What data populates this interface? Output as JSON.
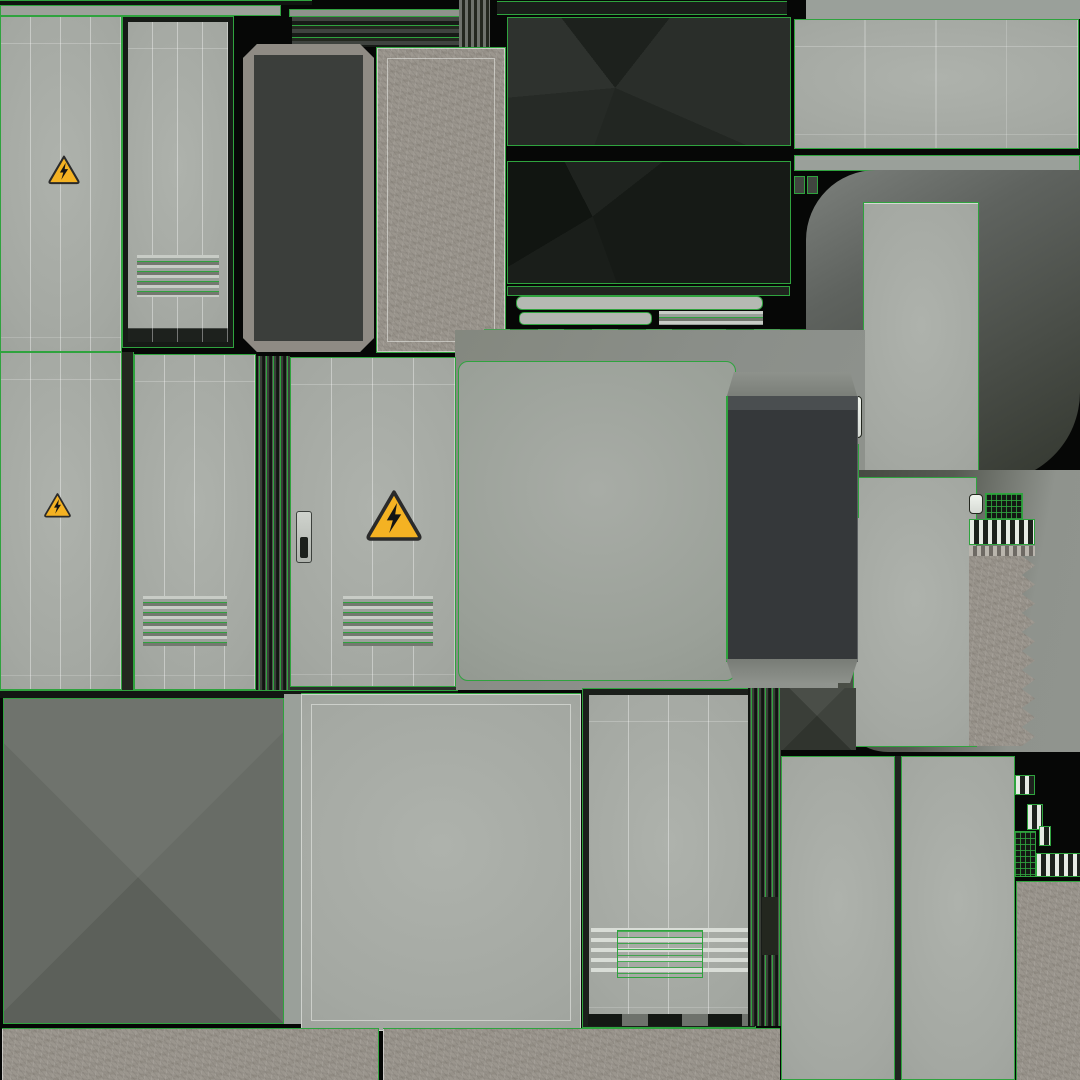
{
  "meta": {
    "title": "Electrical cabinet texture atlas",
    "canvas": {
      "w": 1080,
      "h": 1080
    },
    "background": "#060706"
  },
  "palette": {
    "uv_wireframe_green": "#2fa33e",
    "panel_gray_light": "#aeb2ac",
    "panel_gray": "#a4a8a2",
    "field_gray": "#8b8f8a",
    "charcoal": "#35383a",
    "near_black": "#171b17",
    "concrete": "#9b968e",
    "warning_yellow": "#f4b223",
    "danger_red": "#b3242c",
    "white_line": "#e8ece6"
  },
  "signs": {
    "danger_label": {
      "danger_text": "DANGER",
      "warn_glyph": "⚠",
      "line1": "HIGH",
      "line2": "VOLTAGE",
      "rect": {
        "x": 175,
        "y": 499,
        "w": 60,
        "h": 44
      }
    },
    "warning_triangles": [
      {
        "name": "high-voltage-warning-icon",
        "x": 47,
        "y": 153,
        "w": 34,
        "h": 33
      },
      {
        "name": "high-voltage-warning-icon",
        "x": 43,
        "y": 491,
        "w": 29,
        "h": 28
      },
      {
        "name": "high-voltage-warning-icon",
        "x": 364,
        "y": 487,
        "w": 60,
        "h": 56
      }
    ]
  },
  "panels": [
    {
      "name": "separator-top-dark",
      "kind": "bar",
      "x": 0,
      "y": 0,
      "w": 312,
      "h": 5,
      "css": {
        "background": "#101410",
        "boxShadow": "inset 0 1px 0 #2fa33e"
      }
    },
    {
      "name": "rail-top-left",
      "kind": "bar gb",
      "x": 0,
      "y": 5,
      "w": 281,
      "h": 11,
      "css": {
        "background": "#9da19b"
      }
    },
    {
      "name": "rail-top-mid",
      "kind": "bar gb",
      "x": 289,
      "y": 9,
      "w": 173,
      "h": 8,
      "css": {
        "background": "#8f938d"
      }
    },
    {
      "name": "vent-top-horizontal",
      "kind": "vent-h-dark",
      "x": 292,
      "y": 17,
      "w": 172,
      "h": 30
    },
    {
      "name": "vent-top-vertical",
      "kind": "vent-v-dark",
      "x": 459,
      "y": 0,
      "w": 31,
      "h": 48
    },
    {
      "name": "rail-top-dark",
      "kind": "bar",
      "x": 497,
      "y": 1,
      "w": 290,
      "h": 14,
      "css": {
        "background": "#1a1e1a",
        "boxShadow": "inset 0 1px 0 #2fa33e, inset 0 -1px 0 #2fa33e"
      }
    },
    {
      "name": "field-top-right",
      "kind": "bar",
      "x": 806,
      "y": 0,
      "w": 274,
      "h": 19,
      "css": {
        "background": "#9aa09a"
      }
    },
    {
      "name": "panel-top-right",
      "kind": "plate gb seams",
      "x": 794,
      "y": 19,
      "w": 285,
      "h": 130
    },
    {
      "name": "rail-top-right",
      "kind": "bar gb",
      "x": 794,
      "y": 155,
      "w": 286,
      "h": 16,
      "css": {
        "background": "#9aa09a"
      }
    },
    {
      "name": "hinge-block-1",
      "kind": "bar gb",
      "x": 794,
      "y": 176,
      "w": 11,
      "h": 18,
      "css": {
        "background": "#40453f"
      }
    },
    {
      "name": "hinge-block-2",
      "kind": "bar gb",
      "x": 807,
      "y": 176,
      "w": 11,
      "h": 18,
      "css": {
        "background": "#40453f"
      }
    },
    {
      "name": "cabinet-door-a",
      "kind": "plate gb seams",
      "x": 0,
      "y": 16,
      "w": 122,
      "h": 336
    },
    {
      "name": "cabinet-door-b",
      "kind": "plate gb seams",
      "x": 123,
      "y": 17,
      "w": 110,
      "h": 330,
      "css": {
        "border": "5px solid #161a16",
        "boxShadow": "0 0 0 1px #2fa33e, inset 0 -14px 0 #1d211d"
      }
    },
    {
      "name": "vent-door-b",
      "kind": "vent-h-green",
      "x": 137,
      "y": 255,
      "w": 82,
      "h": 42
    },
    {
      "name": "dark-door-framed",
      "kind": "bar octa",
      "x": 243,
      "y": 44,
      "w": 131,
      "h": 308,
      "css": {
        "background": "#3b3e3b",
        "border": "11px solid #8f8b84",
        "boxShadow": "0 0 0 1px #2fa33e"
      }
    },
    {
      "name": "concrete-slab",
      "kind": "concrete gb inset-ring",
      "x": 376,
      "y": 47,
      "w": 130,
      "h": 306
    },
    {
      "name": "roof-black-upper",
      "kind": "dark-facet-1 gb",
      "x": 507,
      "y": 17,
      "w": 284,
      "h": 129
    },
    {
      "name": "roof-black-lower",
      "kind": "dark-facet-2 gb",
      "x": 507,
      "y": 161,
      "w": 284,
      "h": 123
    },
    {
      "name": "trim-bar-dark",
      "kind": "bar gb",
      "x": 507,
      "y": 286,
      "w": 283,
      "h": 10,
      "css": {
        "background": "#20241f"
      }
    },
    {
      "name": "trim-bar-light-long",
      "kind": "bar gb",
      "x": 516,
      "y": 296,
      "w": 247,
      "h": 14,
      "css": {
        "background": "#b5b9b3",
        "borderRadius": "6px"
      }
    },
    {
      "name": "trim-bar-light-short",
      "kind": "bar gb",
      "x": 519,
      "y": 312,
      "w": 133,
      "h": 13,
      "css": {
        "background": "#b2b6b0",
        "borderRadius": "5px"
      }
    },
    {
      "name": "trim-vent-small",
      "kind": "vent-h-green",
      "x": 659,
      "y": 311,
      "w": 104,
      "h": 14
    },
    {
      "name": "trim-vent-dashed",
      "kind": "vent-h-dashed",
      "x": 484,
      "y": 329,
      "w": 328,
      "h": 24
    },
    {
      "name": "trim-bar-bottom",
      "kind": "bar gb",
      "x": 556,
      "y": 354,
      "w": 334,
      "h": 10,
      "css": {
        "background": "#23271f"
      }
    },
    {
      "name": "shadow-surround-upper",
      "kind": "bar",
      "x": 806,
      "y": 170,
      "w": 274,
      "h": 312,
      "css": {
        "background": "linear-gradient(150deg,#7d817d 0%,#5f635f 30%,#33372f 100%)",
        "borderRadius": "70px 0 90px 40px"
      }
    },
    {
      "name": "side-panel-upper",
      "kind": "plate gb",
      "x": 863,
      "y": 202,
      "w": 116,
      "h": 274,
      "css": {
        "boxShadow": "inset 0 11px 0 -10px #d4d8d2"
      }
    },
    {
      "name": "field-center",
      "kind": "bar",
      "x": 455,
      "y": 330,
      "w": 410,
      "h": 360,
      "css": {
        "background": "linear-gradient(120deg,#84887f 0%,#8b8f8a 50%,#90948e 100%)"
      }
    },
    {
      "name": "shadow-surround-lower",
      "kind": "bar",
      "x": 838,
      "y": 470,
      "w": 242,
      "h": 282,
      "css": {
        "background": "linear-gradient(100deg,#43473f 0%,#565a52 40%,#8f938d 75%,#90948e 100%)",
        "borderRadius": "0 0 0 50px"
      }
    },
    {
      "name": "side-panel-lower",
      "kind": "plate gb",
      "x": 853,
      "y": 477,
      "w": 124,
      "h": 270
    },
    {
      "name": "louver-cluster-left",
      "kind": "vent-h-dark",
      "x": 778,
      "y": 513,
      "w": 60,
      "h": 44
    },
    {
      "name": "latch-slat-white",
      "kind": "wslat",
      "x": 851,
      "y": 396,
      "w": 11,
      "h": 42
    },
    {
      "name": "latch-strip-green",
      "kind": "vent-h-overlay",
      "x": 852,
      "y": 444,
      "w": 7,
      "h": 74
    },
    {
      "name": "clip-slat-white",
      "kind": "wslat",
      "x": 969,
      "y": 494,
      "w": 14,
      "h": 20
    },
    {
      "name": "clip-grid-bits",
      "kind": "grid-green",
      "x": 985,
      "y": 493,
      "w": 38,
      "h": 40
    },
    {
      "name": "vent-vertical-right",
      "kind": "vent-v-white",
      "x": 969,
      "y": 519,
      "w": 66,
      "h": 26
    },
    {
      "name": "bellows-cap-stripes",
      "kind": "stripes-x",
      "x": 969,
      "y": 546,
      "w": 66,
      "h": 10
    },
    {
      "name": "bellows-concrete",
      "kind": "concrete bellows",
      "x": 969,
      "y": 556,
      "w": 66,
      "h": 190
    },
    {
      "name": "cabinet-door-j",
      "kind": "plate gb seams",
      "x": 0,
      "y": 352,
      "w": 122,
      "h": 338
    },
    {
      "name": "gap-strip-jk",
      "kind": "bar",
      "x": 122,
      "y": 352,
      "w": 12,
      "h": 338,
      "css": {
        "background": "#23271f",
        "boxShadow": "inset -1px 0 0 #2fa33e"
      }
    },
    {
      "name": "cabinet-door-danger",
      "kind": "plate gb seams",
      "x": 134,
      "y": 354,
      "w": 122,
      "h": 336
    },
    {
      "name": "vent-door-danger",
      "kind": "vent-h-green",
      "x": 143,
      "y": 596,
      "w": 84,
      "h": 50
    },
    {
      "name": "door-edge-strips",
      "kind": "strips-v",
      "x": 256,
      "y": 356,
      "w": 34,
      "h": 334
    },
    {
      "name": "cabinet-door-triangle",
      "kind": "plate gb seams",
      "x": 290,
      "y": 357,
      "w": 166,
      "h": 332
    },
    {
      "name": "vent-door-triangle",
      "kind": "vent-h-green",
      "x": 343,
      "y": 596,
      "w": 90,
      "h": 50
    },
    {
      "name": "door-handle",
      "kind": "handle",
      "x": 296,
      "y": 511,
      "w": 16,
      "h": 52
    },
    {
      "name": "door-bottom-rail",
      "kind": "bar",
      "x": 290,
      "y": 686,
      "w": 166,
      "h": 12,
      "css": {
        "background": "#2b2f2b",
        "boxShadow": "inset 0 1px 0 #2fa33e, inset 0 -1px 0 #2fa33e"
      }
    },
    {
      "name": "big-gray-panel",
      "kind": "plate-soft gb",
      "x": 458,
      "y": 361,
      "w": 278,
      "h": 320
    },
    {
      "name": "charcoal-cap-top",
      "kind": "bar",
      "x": 726,
      "y": 372,
      "w": 132,
      "h": 27,
      "css": {
        "background": "linear-gradient(180deg,#8e928c,#787c76)",
        "clipPath": "polygon(6% 0,94% 0,100% 100%,0 100%)"
      }
    },
    {
      "name": "charcoal-side-panel",
      "kind": "bar",
      "x": 726,
      "y": 396,
      "w": 132,
      "h": 266,
      "css": {
        "background": "linear-gradient(180deg,#4a4e50 0 14px,#35383a 14px)",
        "boxShadow": "inset 2px 0 0 #2fa33e, inset -66px 0 0 -65px #5a5e60"
      }
    },
    {
      "name": "charcoal-cap-bottom",
      "kind": "bar",
      "x": 726,
      "y": 659,
      "w": 132,
      "h": 24,
      "css": {
        "background": "linear-gradient(180deg,#787c76,#8e928c)",
        "clipPath": "polygon(0 0,100% 0,94% 100%,6% 100%)"
      }
    },
    {
      "name": "separator-mid",
      "kind": "bar",
      "x": 0,
      "y": 690,
      "w": 458,
      "h": 8,
      "css": {
        "background": "#121612",
        "boxShadow": "inset 0 1px 0 #2fa33e"
      }
    },
    {
      "name": "facet-wedge",
      "kind": "facet-x-dark",
      "x": 778,
      "y": 688,
      "w": 78,
      "h": 62
    },
    {
      "name": "roof-top-faceted",
      "kind": "facet-x gb",
      "x": 3,
      "y": 698,
      "w": 281,
      "h": 326
    },
    {
      "name": "strip-between-op",
      "kind": "bar",
      "x": 284,
      "y": 694,
      "w": 17,
      "h": 330,
      "css": {
        "background": "#9aa09a"
      }
    },
    {
      "name": "flat-panel-p",
      "kind": "plate inset-ring",
      "x": 301,
      "y": 694,
      "w": 280,
      "h": 337,
      "css": {
        "boxShadow": "inset 0 0 0 1px rgba(245,248,244,.55), 0 -1px 0 #2fa33e"
      }
    },
    {
      "name": "vented-door-q",
      "kind": "plate gb seams",
      "x": 583,
      "y": 689,
      "w": 172,
      "h": 338,
      "css": {
        "border": "6px solid #1b1f1b",
        "boxShadow": "0 0 0 1px #2fa33e"
      }
    },
    {
      "name": "vent-q-white",
      "kind": "vent-h-white",
      "x": 591,
      "y": 928,
      "w": 157,
      "h": 50
    },
    {
      "name": "vent-q-green",
      "kind": "vent-h-overlay",
      "x": 617,
      "y": 930,
      "w": 86,
      "h": 48
    },
    {
      "name": "door-q-sill",
      "kind": "bar",
      "x": 588,
      "y": 1014,
      "w": 162,
      "h": 12,
      "css": {
        "background": "repeating-linear-gradient(90deg,#141814 0 34px,#6e726c 34px 60px)"
      }
    },
    {
      "name": "door-edge-strips-q",
      "kind": "strips-v",
      "x": 748,
      "y": 688,
      "w": 33,
      "h": 338
    },
    {
      "name": "edge-dark-mark",
      "kind": "bar",
      "x": 762,
      "y": 897,
      "w": 16,
      "h": 58,
      "css": {
        "background": "#23271f"
      }
    },
    {
      "name": "tall-panel-r",
      "kind": "plate gb",
      "x": 781,
      "y": 756,
      "w": 114,
      "h": 324
    },
    {
      "name": "separator-rs",
      "kind": "bar",
      "x": 895,
      "y": 756,
      "w": 6,
      "h": 324,
      "css": {
        "background": "#202420"
      }
    },
    {
      "name": "tall-panel-s",
      "kind": "plate gb",
      "x": 901,
      "y": 756,
      "w": 114,
      "h": 324
    },
    {
      "name": "connector-slat-1",
      "kind": "vent-v-white",
      "x": 1015,
      "y": 775,
      "w": 20,
      "h": 20
    },
    {
      "name": "connector-slat-2",
      "kind": "vent-v-white",
      "x": 1027,
      "y": 804,
      "w": 16,
      "h": 26
    },
    {
      "name": "connector-slat-3",
      "kind": "vent-v-white",
      "x": 1039,
      "y": 826,
      "w": 12,
      "h": 20
    },
    {
      "name": "connector-grid",
      "kind": "grid-green",
      "x": 1014,
      "y": 831,
      "w": 22,
      "h": 46
    },
    {
      "name": "connector-slat-4",
      "kind": "vent-v-white",
      "x": 1036,
      "y": 853,
      "w": 46,
      "h": 24
    },
    {
      "name": "concrete-column",
      "kind": "concrete",
      "x": 1016,
      "y": 881,
      "w": 64,
      "h": 199,
      "css": {
        "boxShadow": "inset 1px 0 0 #2fa33e, inset 0 1px 0 #2fa33e, inset 0 12px 0 -11px #d4d8d2"
      }
    },
    {
      "name": "concrete-base-strip-1",
      "kind": "concrete",
      "x": 2,
      "y": 1028,
      "w": 377,
      "h": 52,
      "css": {
        "boxShadow": "inset 0 1px 0 #2fa33e, inset -1px 0 0 #2fa33e, inset 16px 0 0 -15px rgba(255,255,255,.5)"
      }
    },
    {
      "name": "concrete-base-strip-2",
      "kind": "concrete",
      "x": 383,
      "y": 1028,
      "w": 397,
      "h": 52,
      "css": {
        "boxShadow": "inset 0 1px 0 #2fa33e, inset 8px 0 0 -7px rgba(255,255,255,.5)"
      }
    }
  ]
}
